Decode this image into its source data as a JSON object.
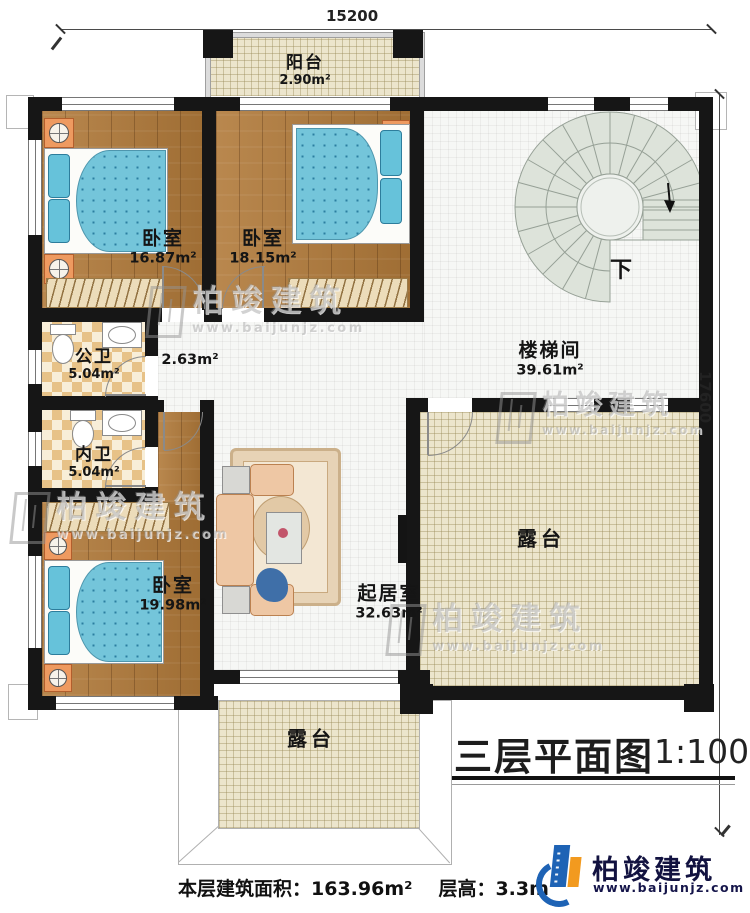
{
  "dimensions": {
    "top": "15200",
    "right": "17600"
  },
  "rooms": [
    {
      "name": "阳台",
      "area": "2.90m²"
    },
    {
      "name": "卧室",
      "area": "16.87m²"
    },
    {
      "name": "卧室",
      "area": "18.15m²"
    },
    {
      "name": "楼梯间",
      "area": "39.61m²"
    },
    {
      "name": "公卫",
      "area": "5.04m²"
    },
    {
      "name": "内卫",
      "area": "5.04m²"
    },
    {
      "name": "",
      "area": "2.63m²"
    },
    {
      "name": "卧室",
      "area": "19.98m²"
    },
    {
      "name": "起居室",
      "area": "32.63m²"
    },
    {
      "name": "露台",
      "area": ""
    },
    {
      "name": "露台",
      "area": ""
    }
  ],
  "stairs": {
    "direction_label": "下"
  },
  "title": {
    "text": "三层平面图",
    "scale": "1:100"
  },
  "footer": {
    "floor_area": "本层建筑面积：163.96m²",
    "floor_height": "层高：3.3m"
  },
  "logo": {
    "name": "柏竣建筑",
    "website": "www.baijunjz.com"
  },
  "watermark": {
    "name": "柏竣建筑",
    "website": "www.baijunjz.com"
  },
  "colors": {
    "wall": "#161616",
    "wood": "#b17a3a",
    "bed": "#74c5da",
    "bath_tile": "#e7c288",
    "terrace": "#ece5cc",
    "stair": "#dde3da",
    "logo_blue": "#1e63b5",
    "logo_orange": "#f29a1f"
  }
}
